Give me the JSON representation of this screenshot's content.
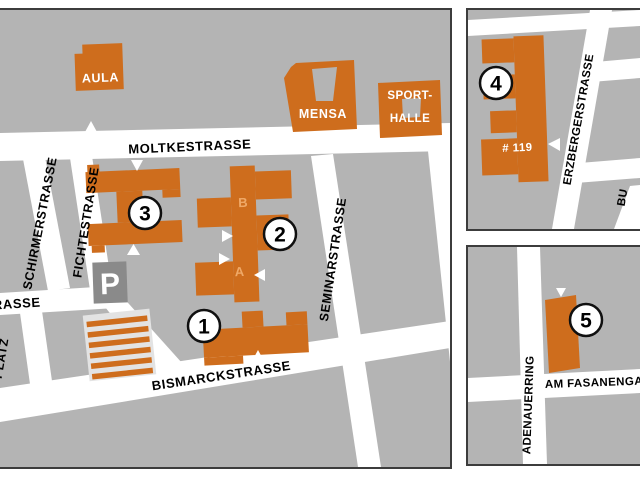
{
  "colors": {
    "map_gray": "#b4b4b4",
    "building_orange": "#ce6d1d",
    "street_white": "#ffffff",
    "parking_gray": "#8a8a8a",
    "stripe_bg": "#e3e3e3",
    "panel_border": "#3c3c3c",
    "wing_letter": "#efa968"
  },
  "main": {
    "streets": {
      "moltke": "MOLTKESTRASSE",
      "schirmer": "SCHIRMERSTRASSE",
      "fichte": "FICHTESTRASSE",
      "seminar": "SEMINARSTRASSE",
      "bismarck": "BISMARCKSTRASSE",
      "rasse_partial": "RASSE",
      "platz_partial": "PLATZ"
    },
    "buildings": {
      "aula": "AULA",
      "mensa": "MENSA",
      "sport1": "SPORT-",
      "sport2": "HALLE",
      "parking": "P",
      "wingA": "A",
      "wingB": "B"
    },
    "markers": {
      "m1": "1",
      "m2": "2",
      "m3": "3"
    }
  },
  "inset_top": {
    "streets": {
      "erzberger": "ERZBERGERSTRASSE",
      "partial": "BU"
    },
    "house_number": "# 119",
    "marker": "4"
  },
  "inset_bottom": {
    "streets": {
      "adenauerring": "ADENAUERRING",
      "fasanengarten": "AM FASANENGA"
    },
    "marker": "5"
  }
}
